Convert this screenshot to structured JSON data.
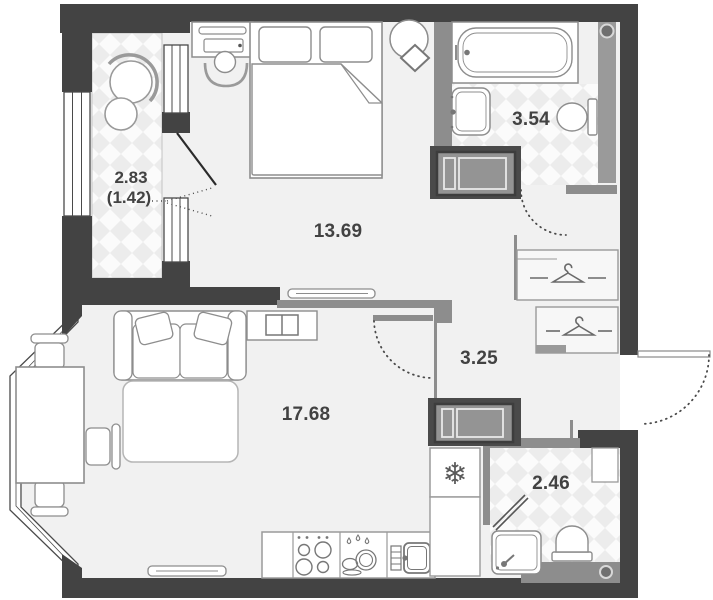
{
  "floorplan": {
    "type": "apartment-floor-plan",
    "rooms": [
      {
        "id": "loggia",
        "area": "2.83",
        "area_secondary": "(1.42)"
      },
      {
        "id": "bedroom",
        "area": "13.69"
      },
      {
        "id": "bathroom",
        "area": "3.54"
      },
      {
        "id": "hallway",
        "area": "3.25"
      },
      {
        "id": "living-kitchen",
        "area": "17.68"
      },
      {
        "id": "wc",
        "area": "2.46"
      }
    ],
    "icons": {
      "fridge_snowflake": "❄"
    },
    "colors": {
      "wall": "#434343",
      "partition": "#8d8d8d",
      "floor": "#f1f1f1",
      "tile_diamond": "#ececec",
      "label_text": "#424242"
    }
  }
}
